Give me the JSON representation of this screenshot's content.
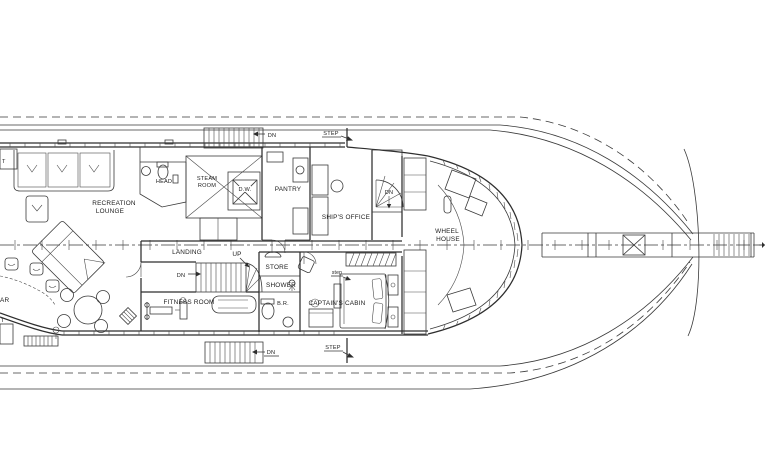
{
  "drawing": {
    "title": "yacht-pilothouse-deck-plan",
    "background_color": "#ffffff",
    "line_color": "#3a3a3a",
    "labels": {
      "recreation_lounge_1": "RECREATION",
      "recreation_lounge_2": "LOUNGE",
      "head": "HEAD",
      "steam_room_1": "STEAM",
      "steam_room_2": "ROOM",
      "dumbwaiter": "D.W.",
      "pantry": "PANTRY",
      "ships_office": "SHIP'S OFFICE",
      "dn_spiral": "DN",
      "wheel_house_1": "WHEEL",
      "wheel_house_2": "HOUSE",
      "landing": "LANDING",
      "up": "UP",
      "dn_mid": "DN",
      "store": "STORE",
      "shower": "SHOWER",
      "bathroom": "B.R.",
      "captains_cabin": "CAPTAIN'S CABIN",
      "step_small": "step",
      "fitness_room": "FITNESS ROOM",
      "dn_top": "DN",
      "step_top": "STEP",
      "dn_bottom": "DN",
      "step_bottom": "STEP",
      "bar_cut": "AR",
      "t_cut_top": "T",
      "t_cut_bottom": "T"
    }
  }
}
